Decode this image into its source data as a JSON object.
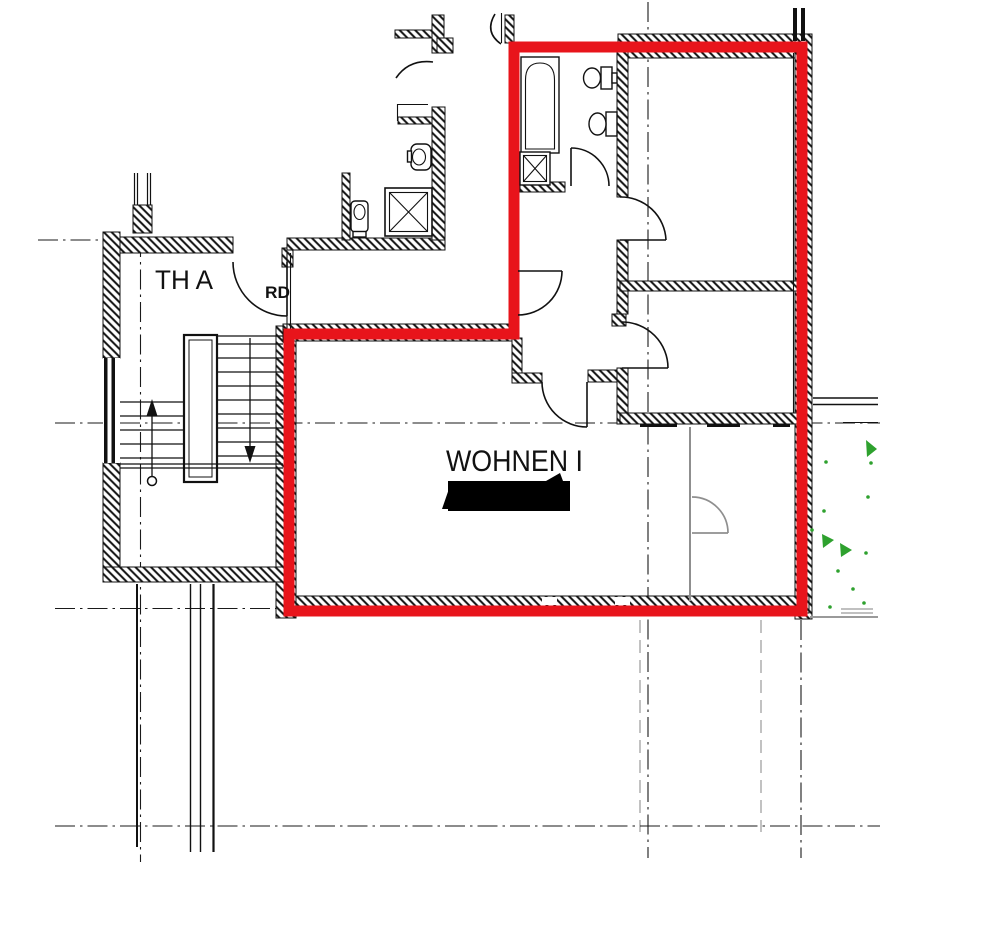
{
  "plan": {
    "labels": {
      "staircase": "TH A",
      "staircase_door": "RD",
      "living_room": "WOHNEN I"
    },
    "colors": {
      "unit_boundary": "#e8141b",
      "wall": "#111111",
      "secondary": "#8f8f8f",
      "vegetation": "#2ea12e"
    },
    "redaction": {
      "present": "true"
    }
  }
}
